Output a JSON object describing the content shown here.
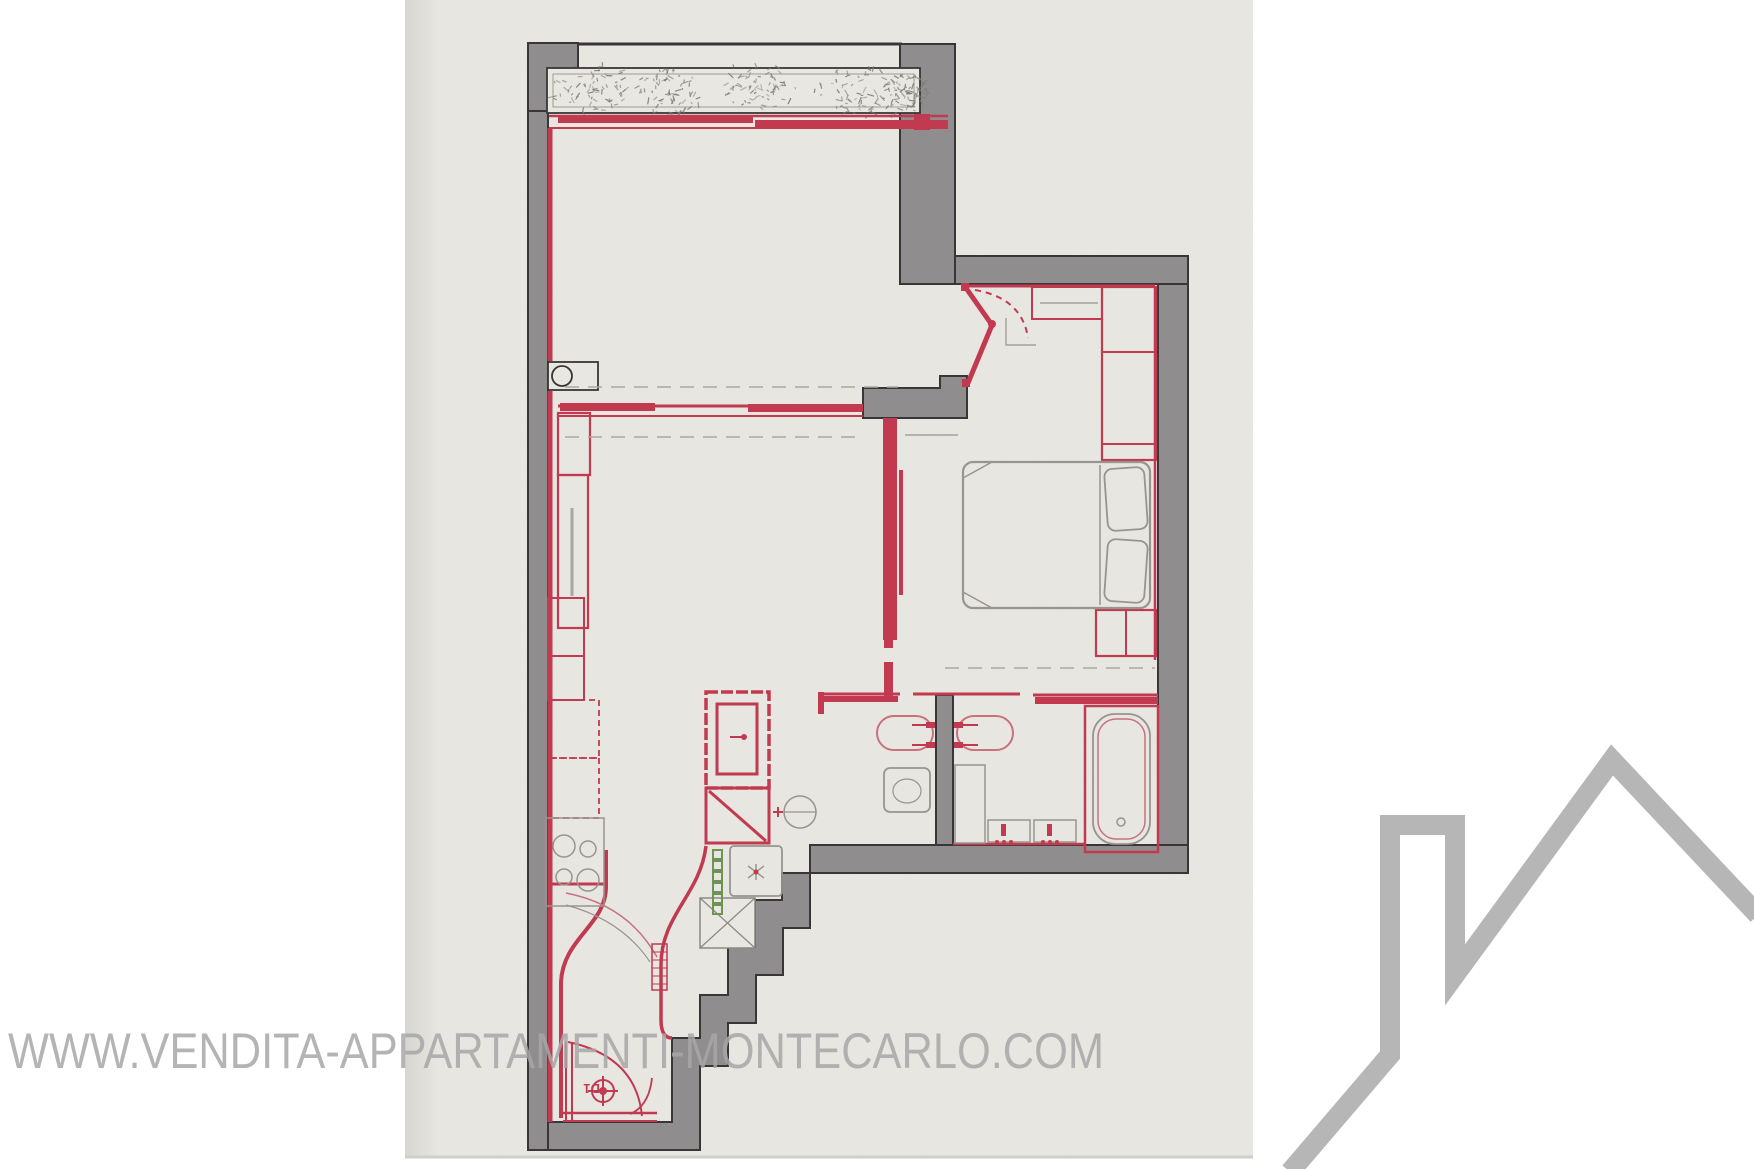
{
  "watermark": {
    "text": "WWW.VENDITA-APPARTAMENTI-MONTECARLO.COM"
  },
  "floor_plan": {
    "entry_door_label": "D1"
  },
  "colors": {
    "background": "#ffffff",
    "paper": "#e8e7e1",
    "paper_edge": "#cfcec9",
    "wall_gray": "#908d8f",
    "outline_ink": "#3a3637",
    "accent_red": "#c23a50",
    "fixture_pink": "#c9717f",
    "furniture_gray": "#98948f",
    "plant_gray": "#7e7c76",
    "vent_green": "#6f9355",
    "watermark_gray": "#a8a7a8",
    "logo_gray": "#b7b6b7"
  }
}
